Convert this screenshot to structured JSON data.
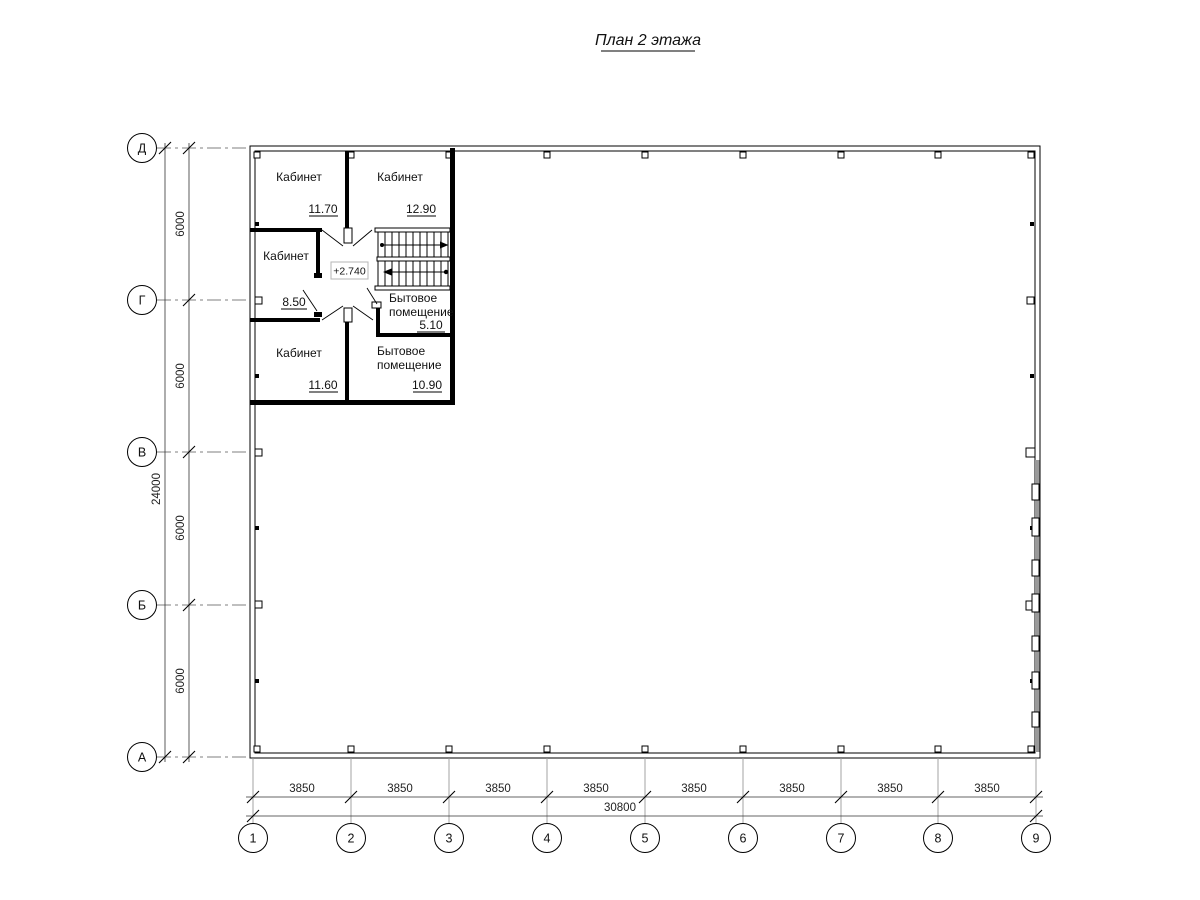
{
  "title": "План 2 этажа",
  "level_mark": "+2.740",
  "rooms": [
    {
      "name": "Кабинет",
      "area": "11.70"
    },
    {
      "name": "Кабинет",
      "area": "12.90"
    },
    {
      "name": "Кабинет",
      "area": "8.50"
    },
    {
      "name": "Бытовое",
      "name2": "помещение",
      "area": "5.10"
    },
    {
      "name": "Кабинет",
      "area": "11.60"
    },
    {
      "name": "Бытовое",
      "name2": "помещение",
      "area": "10.90"
    }
  ],
  "axes_rows": [
    {
      "label": "Д"
    },
    {
      "label": "Г"
    },
    {
      "label": "В"
    },
    {
      "label": "Б"
    },
    {
      "label": "А"
    }
  ],
  "axes_cols": [
    {
      "label": "1"
    },
    {
      "label": "2"
    },
    {
      "label": "3"
    },
    {
      "label": "4"
    },
    {
      "label": "5"
    },
    {
      "label": "6"
    },
    {
      "label": "7"
    },
    {
      "label": "8"
    },
    {
      "label": "9"
    }
  ],
  "dims": {
    "row_segments": [
      "6000",
      "6000",
      "6000",
      "6000"
    ],
    "rows_total": "24000",
    "col_segments": [
      "3850",
      "3850",
      "3850",
      "3850",
      "3850",
      "3850",
      "3850",
      "3850"
    ],
    "cols_total": "30800"
  }
}
